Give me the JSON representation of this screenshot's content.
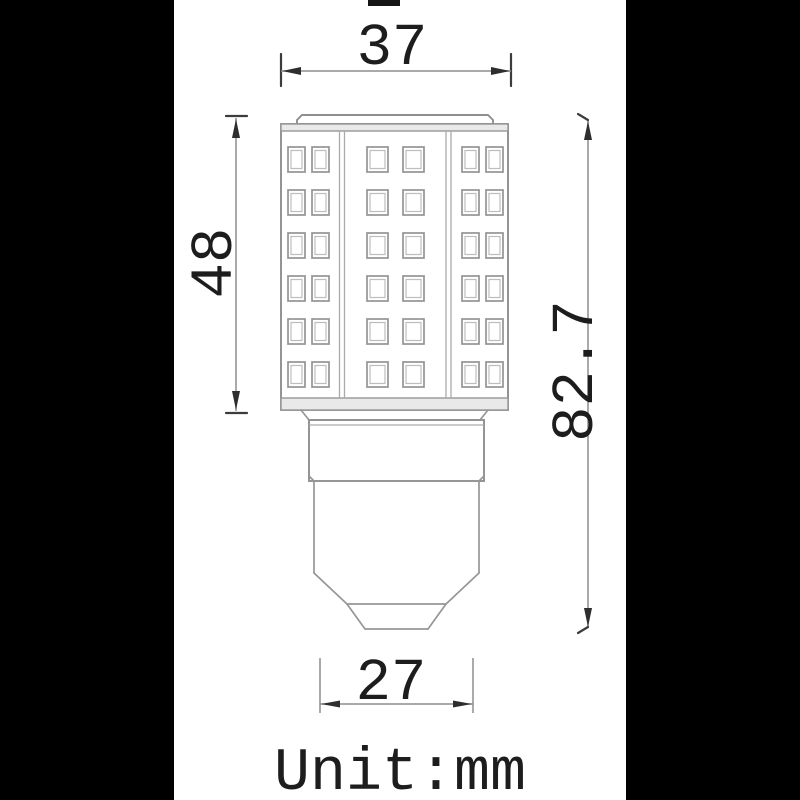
{
  "drawing": {
    "subject": "led-bulb-dimension-drawing",
    "unit_label": "Unit:mm",
    "dimensions": {
      "top_width": {
        "label": "37",
        "value_mm": 37,
        "orientation": "horizontal"
      },
      "led_height": {
        "label": "48",
        "value_mm": 48,
        "orientation": "vertical"
      },
      "total_height": {
        "label": "82.7",
        "value_mm": 82.7,
        "orientation": "vertical"
      },
      "base_width": {
        "label": "27",
        "value_mm": 27,
        "orientation": "horizontal"
      }
    },
    "led_grid": {
      "rows": 6,
      "columns": 3,
      "chips_per_column": 2,
      "total_chips_visible": 36
    },
    "colors": {
      "background": "#000000",
      "paper": "#ffffff",
      "line": "#969696",
      "text": "#1d1d1d"
    }
  }
}
